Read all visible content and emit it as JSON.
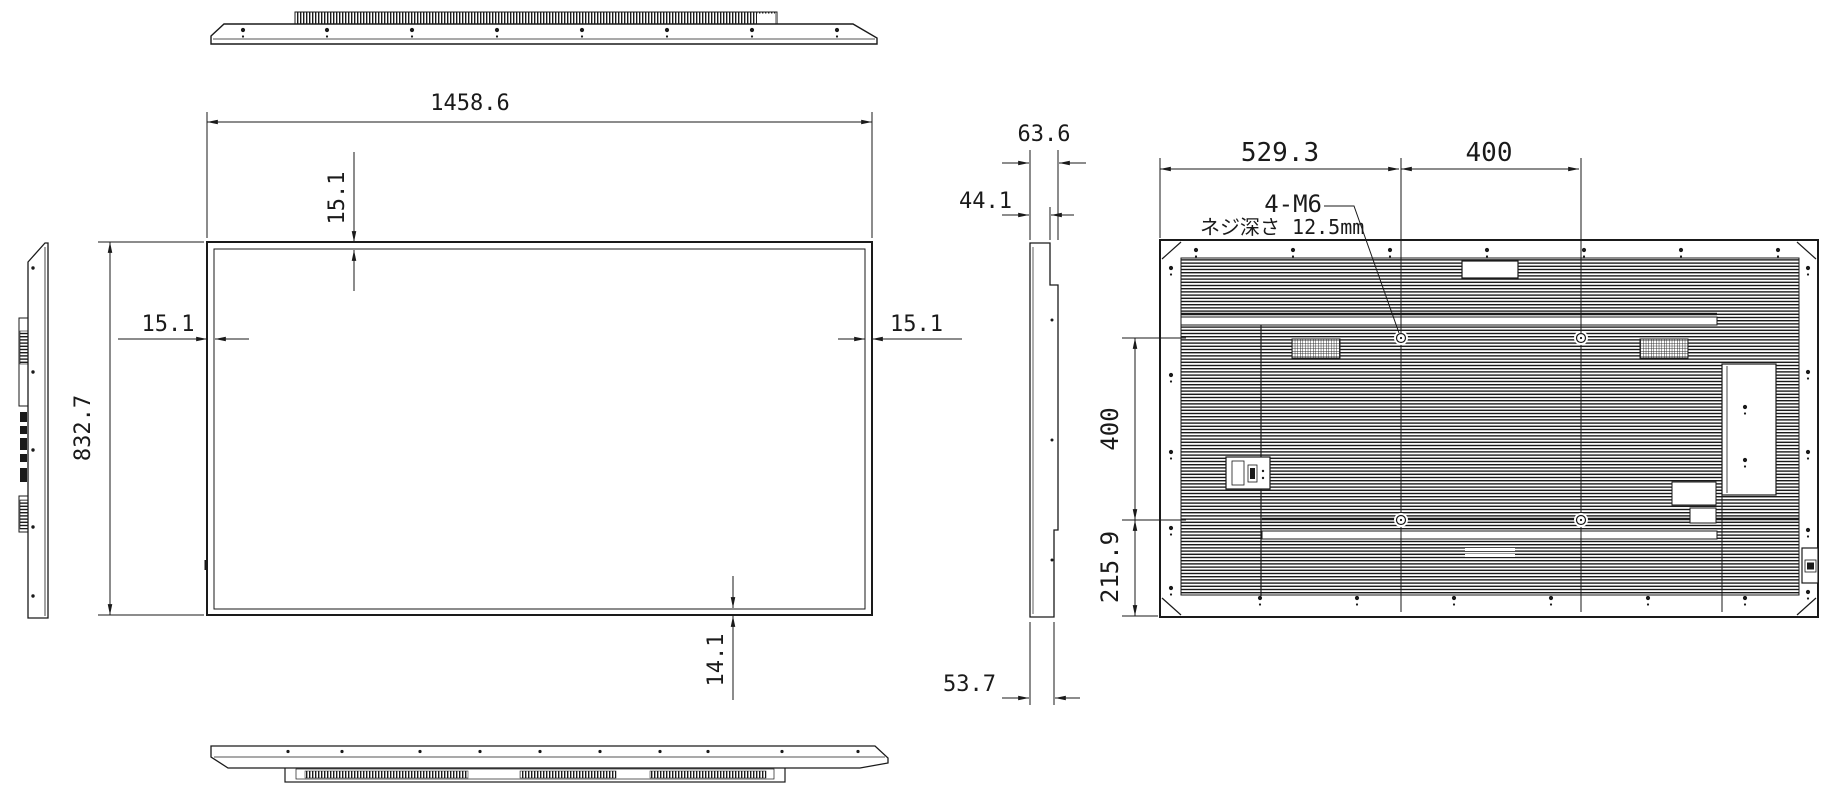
{
  "front": {
    "width": "1458.6",
    "height": "832.7",
    "bezel_top": "15.1",
    "bezel_left": "15.1",
    "bezel_right": "15.1",
    "bezel_bottom": "14.1"
  },
  "side": {
    "depth_total": "63.6",
    "depth_body": "44.1",
    "depth_bottom": "53.7"
  },
  "rear": {
    "vesa_offset_left": "529.3",
    "vesa_pitch_h": "400",
    "vesa_pitch_v": "400",
    "vesa_offset_bottom": "215.9",
    "screw_spec": "4-M6",
    "screw_depth_note": "ネジ深さ 12.5mm"
  },
  "colors": {
    "line": "#1a1a1a",
    "background": "#ffffff"
  }
}
